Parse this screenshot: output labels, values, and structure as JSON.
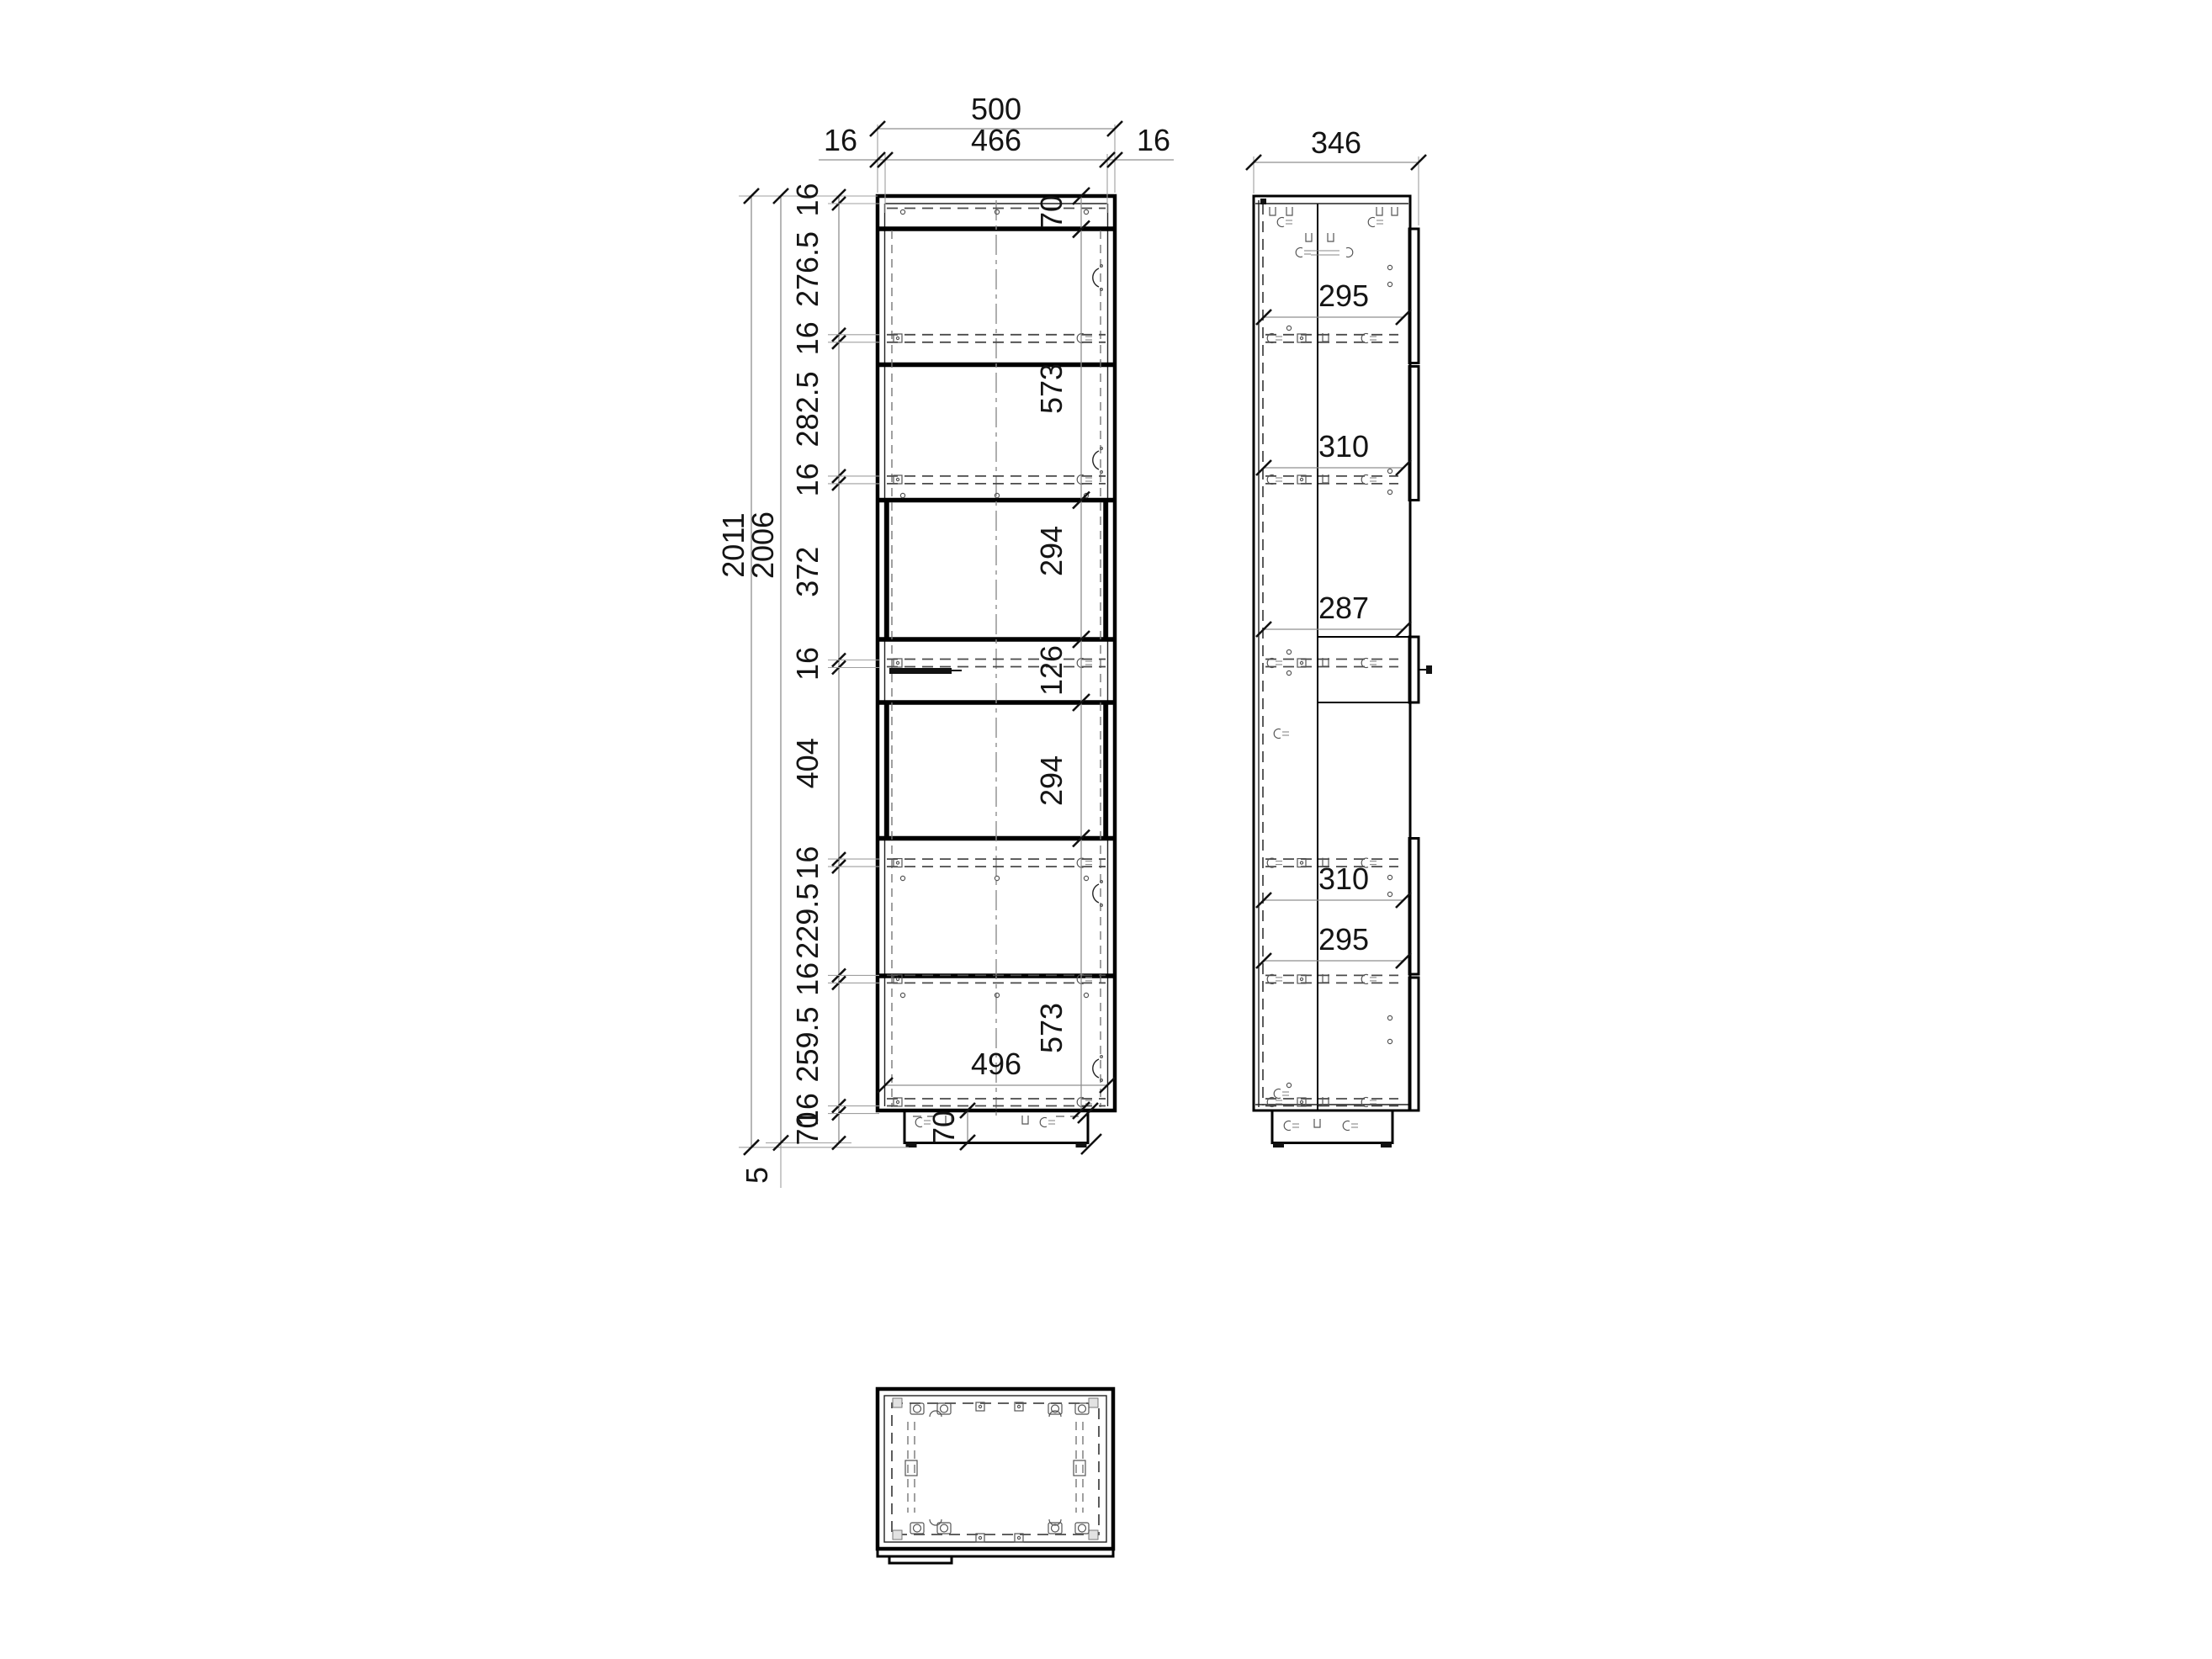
{
  "drawing": {
    "front_view": {
      "dim_width_total": "500",
      "dim_width_inner": "466",
      "dim_width_left": "16",
      "dim_width_right": "16",
      "dim_height_total": "2011",
      "dim_height_body": "2006",
      "dim_feet_gap": "5",
      "left_chain": [
        "16",
        "276.5",
        "16",
        "282.5",
        "16",
        "372",
        "16",
        "404",
        "16",
        "229.5",
        "16",
        "259.5",
        "16",
        "70"
      ],
      "inner_chain": [
        "70",
        "573",
        "294",
        "126",
        "294",
        "573"
      ],
      "dim_bottom_inner_width": "496",
      "dim_plinth_height": "70"
    },
    "side_view": {
      "dim_depth_total": "346",
      "inner_dims": [
        "295",
        "310",
        "287",
        "310",
        "295"
      ]
    },
    "colors": {
      "line": "#000000",
      "dimension_line": "#8f8f8f",
      "hidden_line": "#4a4a4a",
      "background": "#ffffff"
    }
  }
}
